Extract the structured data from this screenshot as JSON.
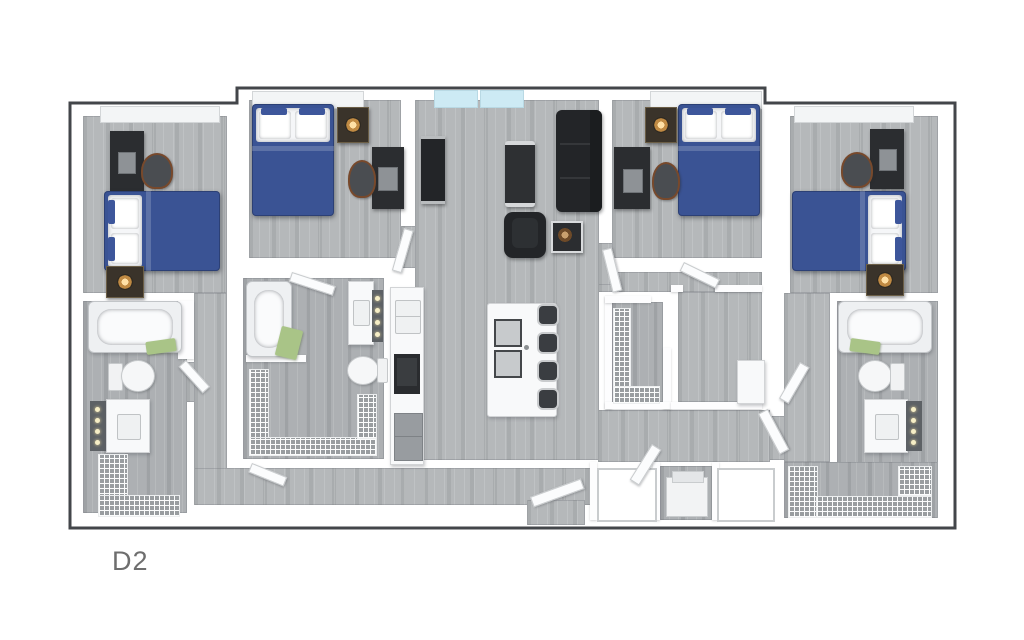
{
  "plan": {
    "label": "D2",
    "type": "apartment-floor-plan-3d-top-view",
    "colors": {
      "boundary": "#43464a",
      "wall": "#ffffff",
      "floor_wood": "#b5b8ba",
      "bed_blue": "#3a5394",
      "towel_green": "#a9c487",
      "window_glass": "#cdeaf4",
      "furniture_dark": "#2b2d30",
      "vanity_dark": "#5d6165",
      "lamp_glow": "#ffe0a6",
      "label_gray": "#6e6e6e"
    },
    "rooms": [
      {
        "name": "bedroom-1",
        "furniture": [
          "double-bed-blue",
          "desk-with-monitor",
          "desk-chair",
          "nightstand-with-lamp",
          "window"
        ]
      },
      {
        "name": "bathroom-1",
        "furniture": [
          "bathtub",
          "toilet",
          "vanity-with-sink-and-lights",
          "wire-shelf-closet"
        ]
      },
      {
        "name": "bedroom-2",
        "furniture": [
          "double-bed-blue",
          "desk-with-laptop",
          "desk-chair",
          "nightstand-with-lamp",
          "window"
        ]
      },
      {
        "name": "bathroom-2",
        "furniture": [
          "bathtub",
          "toilet",
          "vanity-with-sink-and-lights",
          "wire-shelf-closet",
          "green-towel"
        ]
      },
      {
        "name": "living-room",
        "furniture": [
          "sofa",
          "armchair",
          "coffee-table",
          "tv-console",
          "side-table",
          "glass-windows"
        ]
      },
      {
        "name": "kitchen",
        "furniture": [
          "island-with-cooktop",
          "bar-stool",
          "bar-stool",
          "bar-stool",
          "bar-stool",
          "sink",
          "range",
          "refrigerator"
        ]
      },
      {
        "name": "bedroom-3",
        "furniture": [
          "double-bed-blue",
          "desk-with-monitor",
          "desk-chair",
          "nightstand-with-lamp",
          "window"
        ]
      },
      {
        "name": "walk-in-closet-3",
        "furniture": [
          "wire-shelving"
        ]
      },
      {
        "name": "flex-room-3",
        "furniture": [
          "cabinet"
        ]
      },
      {
        "name": "laundry",
        "furniture": [
          "washer",
          "stacked-unit",
          "dryer"
        ]
      },
      {
        "name": "bedroom-4",
        "furniture": [
          "double-bed-blue",
          "desk-with-monitor",
          "desk-chair",
          "nightstand-with-lamp",
          "window"
        ]
      },
      {
        "name": "bathroom-4",
        "furniture": [
          "bathtub",
          "toilet",
          "vanity-with-sink-and-lights",
          "wire-shelf-closet"
        ]
      }
    ]
  }
}
